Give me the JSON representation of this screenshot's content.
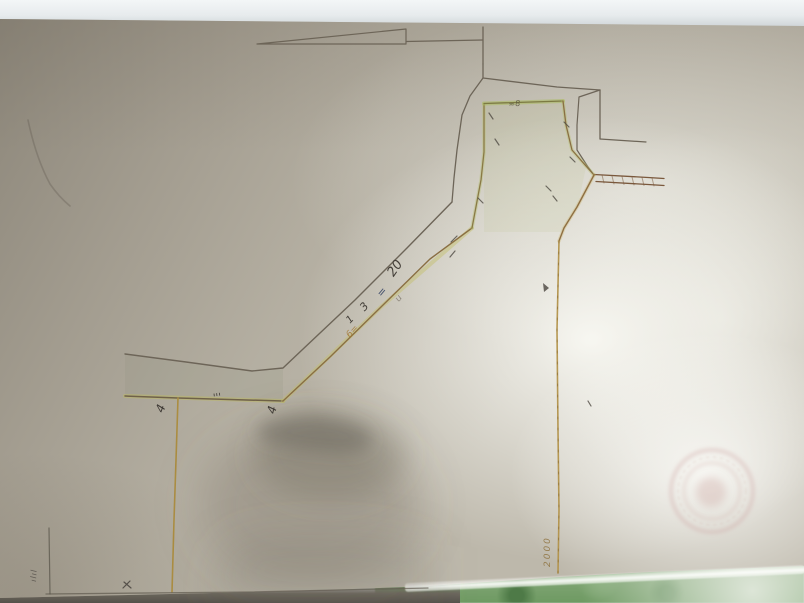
{
  "scene": {
    "subject": "photograph of a hand-drawn cadastral survey sketch on aged paper",
    "paper_base_color": "#bdb8ab",
    "paper_bright_color": "#e9e9e2",
    "paper_shadow_topleft_color": "#8a8376",
    "top_band_color": "#edf1f2",
    "table_green_color": "#6e9a62",
    "pencil_ink_color": "#6d6558",
    "ochre_ink_color": "#b2924a",
    "green_highlight_color": "#aab264",
    "road_ink_color": "#7a583c",
    "stamp_color": "#c99c99"
  },
  "drawing": {
    "shapes": [
      {
        "name": "band-shade",
        "type": "polygon",
        "points": "125,355 252,372 283,369 283,401 178,398 125,396",
        "fill": "rgba(130,140,118,0.13)"
      },
      {
        "name": "parcel-head-wash",
        "type": "polygon",
        "points": "484,104 563,101 567,130 573,152 586,167 578,205 562,232 484,232 484,152",
        "fill": "rgba(185,190,125,0.12)"
      },
      {
        "name": "paper-crease",
        "type": "path",
        "d": "M28,120 Q36,158 50,184 Q59,197 70,206",
        "stroke": "rgba(75,68,58,0.25)",
        "width": 1.6
      },
      {
        "name": "scale-bar-triangle",
        "type": "path",
        "d": "M257,44 L406,29 L406,44 Z",
        "stroke": "#6d6558",
        "width": 1.2
      },
      {
        "name": "scale-bar-line",
        "type": "path",
        "d": "M406,41.5 L483,40",
        "stroke": "#6d6558",
        "width": 1.2
      },
      {
        "name": "scale-bar-tick",
        "type": "path",
        "d": "M483,27 L483,64",
        "stroke": "#6d6558",
        "width": 1.3
      },
      {
        "name": "outer-boundary-head-top",
        "type": "path",
        "d": "M483,64 L483,78 L557,87 L600,90",
        "stroke": "#6d6558",
        "width": 1.3
      },
      {
        "name": "outer-boundary-head-right",
        "type": "path",
        "d": "M600,90 L600,139",
        "stroke": "#6d6558",
        "width": 1.3
      },
      {
        "name": "lot-line-east",
        "type": "path",
        "d": "M600,139 L646,142",
        "stroke": "#6d6558",
        "width": 1.2
      },
      {
        "name": "outer-boundary-notch",
        "type": "path",
        "d": "M600,90 L579,97 L577,125 L577,150 L588,167 L594,175",
        "stroke": "#6d6558",
        "width": 1.2
      },
      {
        "name": "outer-boundary-west-upper",
        "type": "path",
        "d": "M483,78 L470,96 L462,115 L457,150 L454,178 L452,202",
        "stroke": "#6d6558",
        "width": 1.3
      },
      {
        "name": "outer-boundary-diagonal",
        "type": "path",
        "d": "M452,202 L407,248 L355,300 L302,350 L283,368 L252,371 L186,362 L125,354",
        "stroke": "#6d6558",
        "width": 1.4
      },
      {
        "name": "parcel-boundary-west-underlay",
        "type": "path",
        "d": "M125,396 L283,401",
        "stroke": "rgba(190,185,100,0.5)",
        "width": 4
      },
      {
        "name": "parcel-boundary-west",
        "type": "path",
        "d": "M125,396 L178,398 L283,401",
        "stroke": "#6f6149",
        "width": 1.5
      },
      {
        "name": "parcel-boundary-diagonal-underlay",
        "type": "path",
        "d": "M283,401 L382,306 L472,228",
        "stroke": "rgba(195,190,105,0.45)",
        "width": 4
      },
      {
        "name": "parcel-boundary-diagonal",
        "type": "path",
        "d": "M283,401 L330,357 L382,306 L430,259 L472,228",
        "stroke": "#8a6f43",
        "width": 1.4
      },
      {
        "name": "parcel-boundary-headwest-underlay",
        "type": "path",
        "d": "M472,228 L481,180 L484,152 L484,104",
        "stroke": "rgba(180,190,110,0.4)",
        "width": 3.5
      },
      {
        "name": "parcel-boundary-headwest",
        "type": "path",
        "d": "M472,228 L481,180 L484,152 L484,104",
        "stroke": "#8a7a45",
        "width": 1.3
      },
      {
        "name": "parcel-boundary-headtop-underlay",
        "type": "path",
        "d": "M484,103.5 L563,101",
        "stroke": "rgba(170,185,95,0.55)",
        "width": 4
      },
      {
        "name": "parcel-boundary-headtop",
        "type": "path",
        "d": "M484,103.5 L563,101",
        "stroke": "#7c7a42",
        "width": 1.3
      },
      {
        "name": "parcel-boundary-headeast-underlay",
        "type": "path",
        "d": "M563,101 L566,125 L572,150 L586,166 L594,175",
        "stroke": "rgba(180,190,105,0.4)",
        "width": 3.5
      },
      {
        "name": "parcel-boundary-headeast",
        "type": "path",
        "d": "M563,101 L566,125 L572,150 L586,166 L594,175",
        "stroke": "#8a6f43",
        "width": 1.3
      },
      {
        "name": "road-upper-line",
        "type": "path",
        "d": "M594,174.5 L648,177.5 L664,178.5",
        "stroke": "#7a583c",
        "width": 1.3
      },
      {
        "name": "road-lower-line",
        "type": "path",
        "d": "M596,181.5 L648,184.5 L664,185.5",
        "stroke": "#7a583c",
        "width": 1.3
      },
      {
        "name": "road-hatching",
        "type": "path",
        "d": "M602,175 L604,183 M612,176 L614,184 M622,176.5 L624,184.5 M632,177 L634,185 M642,177.5 L644,185.5 M652,178 L654,186",
        "stroke": "rgba(122,88,60,0.5)",
        "width": 1
      },
      {
        "name": "parcel-boundary-junction-south-underlay",
        "type": "path",
        "d": "M594,175 L577,207 L564,228 L559,241",
        "stroke": "rgba(200,180,110,0.35)",
        "width": 3.5
      },
      {
        "name": "parcel-boundary-junction-south",
        "type": "path",
        "d": "M594,175 L577,207 L564,228 L559,241",
        "stroke": "#8f6f42",
        "width": 1.4
      },
      {
        "name": "parcel-boundary-south-vertical",
        "type": "path",
        "d": "M559,241 L557,330 L558,430 L559,510 L558,573",
        "stroke": "#b2924a",
        "width": 1.6,
        "opacity": 0.95
      },
      {
        "name": "parcel-boundary-south-vertical-specks",
        "type": "path",
        "d": "M559,241 L557,330 L558,430 L559,510 L558,573",
        "stroke": "#8a6a35",
        "width": 1,
        "dash": "2 9",
        "opacity": 0.6
      },
      {
        "name": "parcel-boundary-west-vertical",
        "type": "path",
        "d": "M178,398 L176,460 L174,520 L172,592",
        "stroke": "#ab8d41",
        "width": 1.6
      },
      {
        "name": "sheet-bottom-border",
        "type": "path",
        "d": "M46,594 L250,592 L428,588",
        "stroke": "rgba(95,90,78,0.7)",
        "width": 1.3
      },
      {
        "name": "sheet-left-edge-line",
        "type": "path",
        "d": "M49,528 L50,594",
        "stroke": "rgba(90,85,75,0.75)",
        "width": 1.2
      },
      {
        "name": "survey-ticks",
        "type": "path",
        "d": "M478,198 L483,203 M457,236 L451,242 M455,251 L450,257 M489,113 L493,119 M495,139 L499,145 M564,122 L569,127 M570,157 L575,162 M546,186 L551,191 M553,196 L557,201 M588,401 L591,406",
        "stroke": "#4f4a42",
        "width": 1.2,
        "opacity": 0.8
      },
      {
        "name": "arrow-mark",
        "type": "polygon",
        "points": "543,283 549,288 544,292",
        "fill": "rgba(74,69,62,0.8)"
      },
      {
        "name": "x-mark",
        "type": "path",
        "d": "M124,582 L131,588 M130,581 L123,588",
        "stroke": "#55504a",
        "width": 1.2
      },
      {
        "name": "stamp-outer-ring",
        "type": "circle",
        "cx": 712,
        "cy": 491,
        "r": 41,
        "stroke": "rgba(201,156,153,0.5)",
        "width": 2.5,
        "blur": "blur2"
      },
      {
        "name": "stamp-middle-ring",
        "type": "circle",
        "cx": 712,
        "cy": 491,
        "r": 34,
        "stroke": "rgba(200,158,152,0.3)",
        "width": 1,
        "dash": "3 4",
        "blur": "blur1"
      },
      {
        "name": "stamp-inner-ring",
        "type": "circle",
        "cx": 712,
        "cy": 491,
        "r": 28,
        "stroke": "rgba(205,162,158,0.42)",
        "width": 1.8,
        "blur": "blur2"
      },
      {
        "name": "stamp-core",
        "type": "circle",
        "cx": 711,
        "cy": 492,
        "r": 15,
        "fill": "rgba(200,158,152,0.32)",
        "blur": "blur4"
      },
      {
        "name": "hand-shadow-broad",
        "type": "ellipse",
        "cx": 310,
        "cy": 505,
        "rx": 110,
        "ry": 80,
        "fill": "rgba(108,102,90,0.28)",
        "blur": "blur22"
      },
      {
        "name": "hand-shadow-mid",
        "type": "ellipse",
        "cx": 330,
        "cy": 455,
        "rx": 75,
        "ry": 45,
        "fill": "rgba(105,99,87,0.3)",
        "blur": "blur14"
      },
      {
        "name": "hand-shadow-finger",
        "type": "path",
        "d": "M262,424 Q300,409 340,419 Q374,428 372,442 Q366,456 330,452 Q292,449 266,441 Q252,434 262,424 Z",
        "fill": "rgba(98,93,82,0.4)",
        "blur": "blur8"
      },
      {
        "name": "hand-shadow-bottom",
        "type": "path",
        "d": "M230,545 Q320,522 430,548 L430,603 L210,603 Z",
        "fill": "rgba(110,104,94,0.26)",
        "blur": "blur22"
      }
    ]
  },
  "annotations": [
    {
      "name": "measure-20",
      "text": "20",
      "x": 396,
      "y": 266,
      "rot": -55,
      "size": 13,
      "color": "#433e38"
    },
    {
      "name": "measure-equals",
      "text": "=",
      "x": 383,
      "y": 288,
      "rot": -50,
      "size": 11,
      "color": "#4a5570"
    },
    {
      "name": "measure-3",
      "text": "3",
      "x": 366,
      "y": 302,
      "rot": -48,
      "size": 11,
      "color": "#433e38"
    },
    {
      "name": "measure-1",
      "text": "1",
      "x": 352,
      "y": 316,
      "rot": -45,
      "size": 10,
      "color": "#433e38"
    },
    {
      "name": "measure-u",
      "text": "u",
      "x": 401,
      "y": 295,
      "rot": -50,
      "size": 9,
      "color": "#6f675c",
      "opacity": 0.65
    },
    {
      "name": "measure-6",
      "text": "6=",
      "x": 352,
      "y": 331,
      "rot": -48,
      "size": 9,
      "color": "#a2762f",
      "opacity": 0.8
    },
    {
      "name": "corner-4-west",
      "text": "4",
      "x": 165,
      "y": 402,
      "rot": -70,
      "size": 12,
      "color": "#3f3a35"
    },
    {
      "name": "corner-4-east",
      "text": "4",
      "x": 277,
      "y": 403,
      "rot": -76,
      "size": 12,
      "color": "#3f3a35"
    },
    {
      "name": "tick-marks",
      "text": "'''",
      "x": 214,
      "y": 394,
      "rot": -8,
      "size": 10,
      "color": "#45403a"
    },
    {
      "name": "head-note",
      "text": "≈8",
      "x": 509,
      "y": 101,
      "rot": -6,
      "size": 8,
      "color": "#56503f",
      "opacity": 0.8
    },
    {
      "name": "south-2000",
      "text": "2000",
      "x": 553,
      "y": 558,
      "rot": -90,
      "size": 9,
      "color": "#8f7340",
      "opacity": 0.85,
      "spacing": 2
    },
    {
      "name": "left-edge-note",
      "text": "ılıl",
      "x": 38,
      "y": 574,
      "rot": -87,
      "size": 8,
      "color": "#55504a",
      "opacity": 0.85,
      "spacing": 1
    }
  ]
}
